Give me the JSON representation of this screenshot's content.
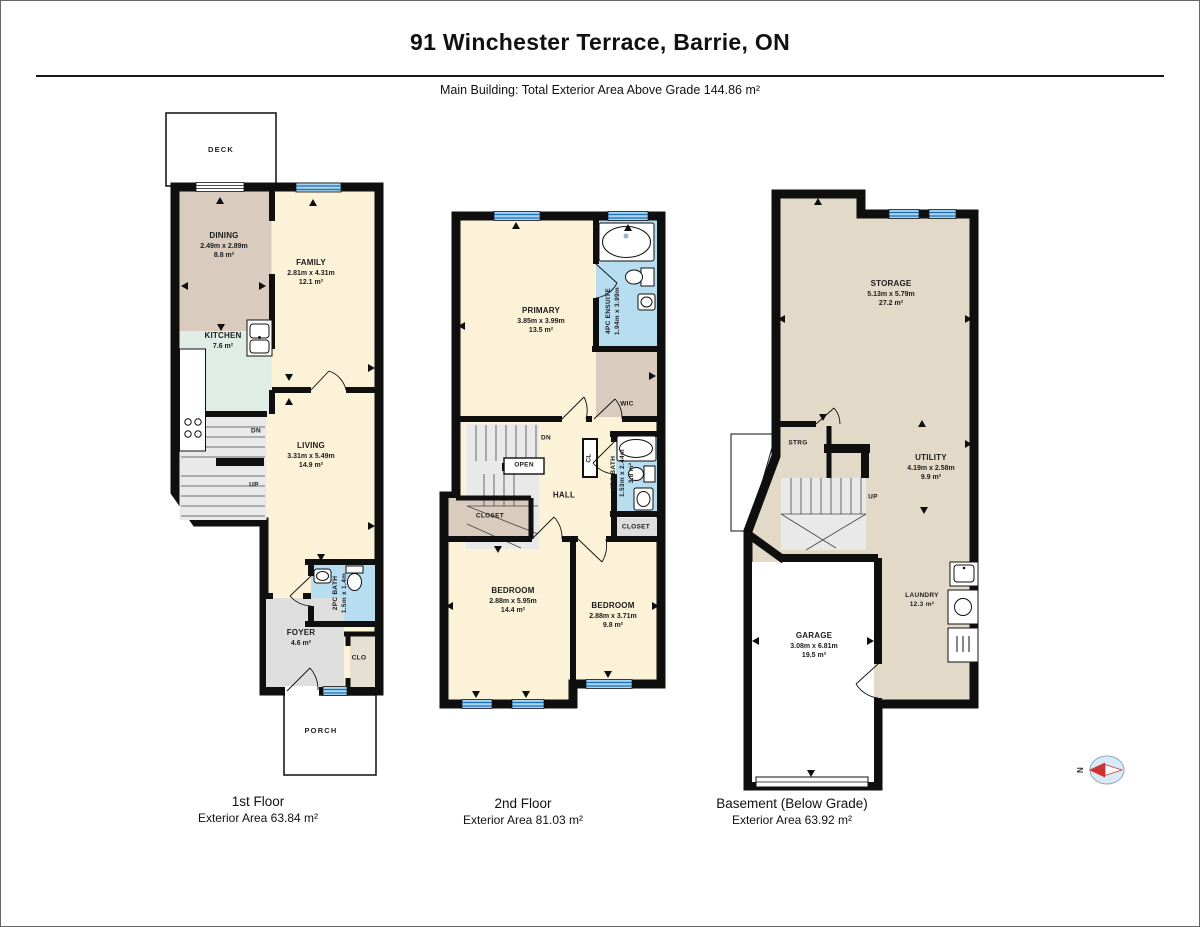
{
  "header": {
    "title": "91 Winchester Terrace, Barrie, ON",
    "subtitle": "Main Building: Total Exterior Area Above Grade 144.86 m²"
  },
  "floor1": {
    "caption": "1st Floor",
    "area": "Exterior Area 63.84 m²",
    "deck": "DECK",
    "porch": "PORCH",
    "dining": {
      "name": "DINING",
      "dims": "2.49m x 2.89m",
      "area": "8.8 m²"
    },
    "family": {
      "name": "FAMILY",
      "dims": "2.81m x 4.31m",
      "area": "12.1 m²"
    },
    "kitchen": {
      "name": "KITCHEN",
      "area": "7.6 m²"
    },
    "living": {
      "name": "LIVING",
      "dims": "3.31m x 5.49m",
      "area": "14.9 m²"
    },
    "bath": {
      "name": "2PC BATH",
      "dims": "1.5m x 1.4m"
    },
    "foyer": {
      "name": "FOYER",
      "area": "4.6 m²"
    },
    "clo": "CLO",
    "dn": "DN",
    "up": "UP"
  },
  "floor2": {
    "caption": "2nd Floor",
    "area": "Exterior Area 81.03 m²",
    "primary": {
      "name": "PRIMARY",
      "dims": "3.85m x 3.99m",
      "area": "13.5 m²"
    },
    "ensuite": {
      "name": "4PC ENSUITE",
      "dims": "1.94m x 3.99m"
    },
    "wic": "WIC",
    "bath": {
      "name": "4PC BATH",
      "dims": "1.53m x 2.44m",
      "area": "3.8 m²"
    },
    "bedroom1": {
      "name": "BEDROOM",
      "dims": "2.88m x 5.95m",
      "area": "14.4 m²"
    },
    "bedroom2": {
      "name": "BEDROOM",
      "dims": "2.88m x 3.71m",
      "area": "9.8 m²"
    },
    "closet_left": "CLOSET",
    "closet_right": "CLOSET",
    "hall": "HALL",
    "cl": "CL",
    "open": "OPEN",
    "dn": "DN"
  },
  "basement": {
    "caption": "Basement (Below Grade)",
    "area": "Exterior Area 63.92 m²",
    "storage": {
      "name": "STORAGE",
      "dims": "5.13m x 5.79m",
      "area": "27.2 m²"
    },
    "utility": {
      "name": "UTILITY",
      "dims": "4.19m x 2.58m",
      "area": "9.9 m²"
    },
    "garage": {
      "name": "GARAGE",
      "dims": "3.08m x 6.81m",
      "area": "19.5 m²"
    },
    "laundry": {
      "name": "LAUNDRY",
      "area": "12.3 m²"
    },
    "strg": "STRG",
    "up": "UP"
  },
  "compass": {
    "north": "N"
  },
  "colors": {
    "wall": "#0f0f0f",
    "room_cream": "#FBF2D7",
    "room_tan": "#D9CBBD",
    "room_mint": "#DFEDE6",
    "room_blue": "#B7DDF0",
    "room_gray": "#E9E9E9",
    "basement_beige": "#E3D9C8",
    "window_fill": "#A9D3EE",
    "window_line": "#1A6FB5",
    "compass_red": "#CC3333"
  }
}
